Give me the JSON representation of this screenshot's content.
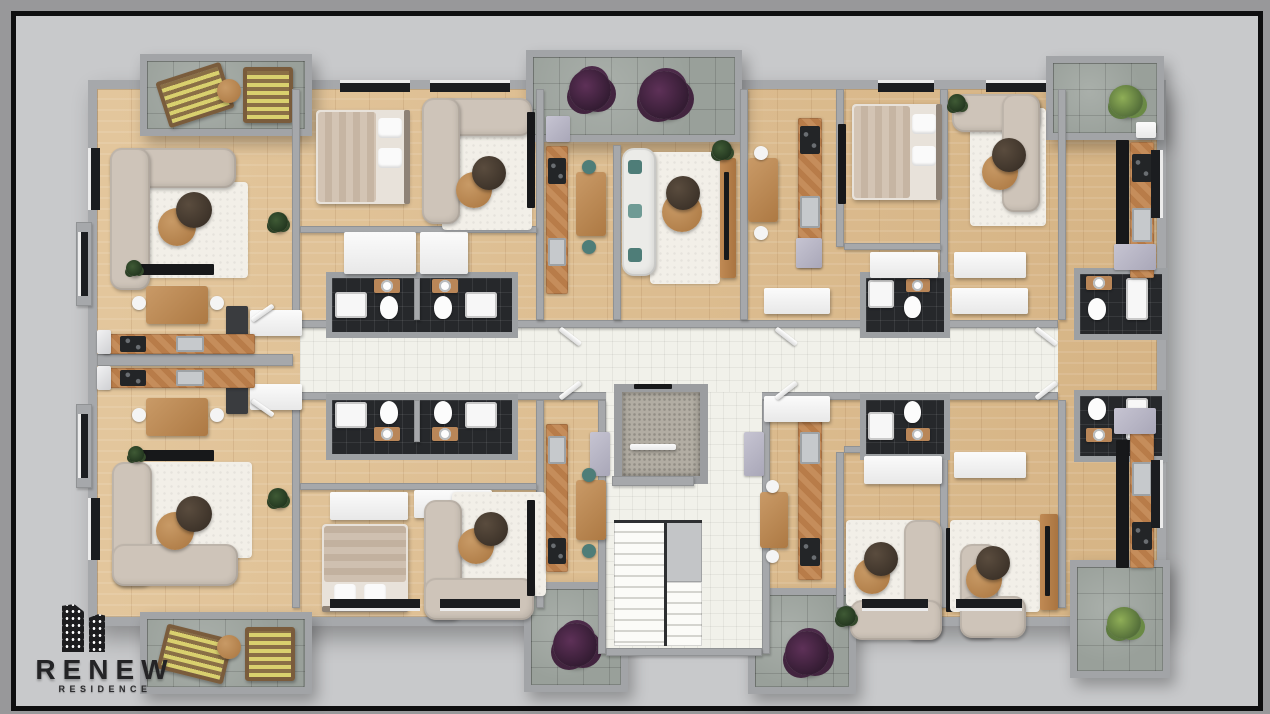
{
  "branding": {
    "name": "RENEW",
    "tagline": "RESIDENCE",
    "logo_icon": "buildings-icon"
  },
  "palette": {
    "background_outer": "#98989a",
    "background_inner": "#c8c9cb",
    "frame": "#0e0e0f",
    "wall": "#a6a8ab",
    "wood_floor": "#dcbd92",
    "corridor_tile": "#f1f1ea",
    "bathroom_tile": "#26282b",
    "balcony_stone": "#99a09a",
    "sofa": "#cec4b9",
    "rug": "#f2efe8",
    "counter_wood": "#b87c49",
    "plant_purple": "#42243f",
    "plant_green": "#6a8a45",
    "logo_text": "#242426"
  },
  "icons": {
    "buildings-icon": "two dark high-rise silhouettes with white window dots",
    "plant-purple-icon": "dark purple shrub blob",
    "plant-green-icon": "green shrub blob"
  },
  "scene": {
    "description": "Top-down 3D architectural rendering of one residential floor with eight apartments around a central white-tiled corridor, elevator shaft and staircase core",
    "corridor": "central horizontal corridor, white tiles",
    "core": [
      "elevator",
      "staircase",
      "stair hall"
    ],
    "apartments": [
      {
        "id": "top-left",
        "rooms": [
          "living room with L-sofa",
          "dining",
          "back-to-back kitchen"
        ],
        "balcony": "top terrace with two striped loungers and round table"
      },
      {
        "id": "top-center-left",
        "rooms": [
          "bedroom",
          "living room with L-sofa",
          "two bathrooms",
          "wardrobes"
        ]
      },
      {
        "id": "top-center",
        "rooms": [
          "kitchen strip",
          "dining",
          "living room with white sofa and TV wall"
        ],
        "balcony": "stone terrace with two purple shrubs"
      },
      {
        "id": "top-right",
        "rooms": [
          "bedroom",
          "living room with L-sofa",
          "dark-cabinet kitchen",
          "bathrooms"
        ],
        "balcony": "corner stone terrace with green plant"
      },
      {
        "id": "bottom-left",
        "rooms": [
          "living room with L-sofa",
          "dining",
          "back-to-back kitchen"
        ],
        "balcony": "bottom terrace with two striped loungers and round table"
      },
      {
        "id": "bottom-center-left",
        "rooms": [
          "bedroom",
          "living room with L-sofa",
          "two bathrooms",
          "wardrobes"
        ]
      },
      {
        "id": "bottom-center",
        "rooms": [
          "kitchen strip",
          "dining"
        ],
        "balconies": [
          "stone terrace with purple shrub",
          "stone terrace with purple shrub"
        ]
      },
      {
        "id": "bottom-right",
        "rooms": [
          "two living rooms with L-sofas",
          "dark-cabinet kitchen",
          "bathrooms"
        ],
        "balcony": "stone terrace with green plant"
      }
    ]
  }
}
